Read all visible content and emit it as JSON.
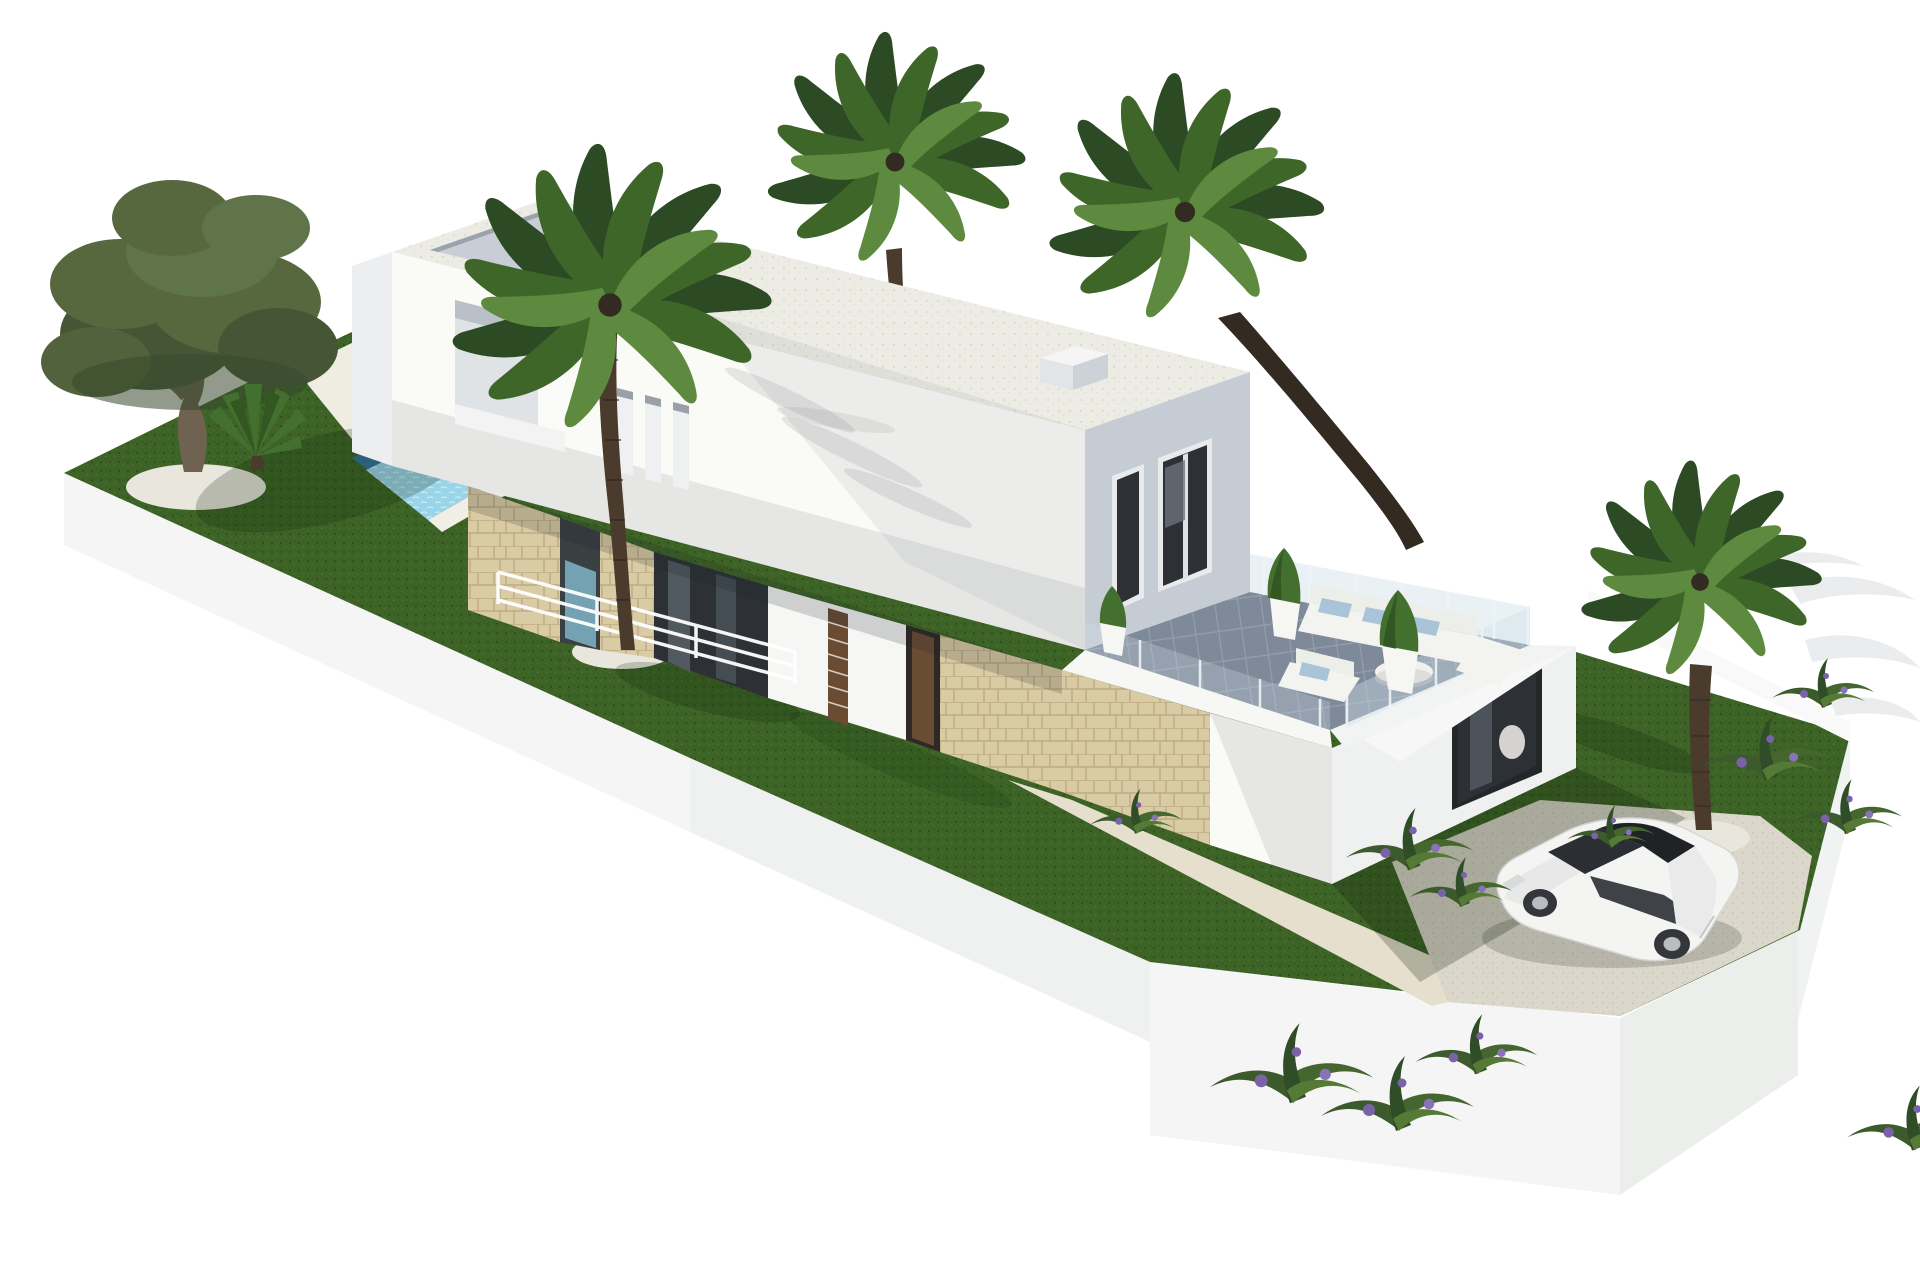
{
  "scene": {
    "description": "3D architectural render of a modern two-storey white villa with pool, palm trees, roof terrace, lawn and parked car on a white background",
    "background": "#ffffff"
  },
  "counts": {
    "palm_trees": 4,
    "olive_trees": 1,
    "cars": 1
  },
  "objects": {
    "villa": "Modern white villa",
    "upper_volume": "Upper floor volume with flat roof",
    "ground_floor": "Ground floor with stone-clad walls",
    "guest_wing": "Single-storey wing with roof terrace",
    "roof_terrace": "Roof terrace with outdoor lounge",
    "pool": "Swimming pool",
    "pool_deck": "White pool deck",
    "lawn": "Lawn",
    "driveway": "Gravel driveway",
    "walkway": "Garden path",
    "car": "White hatchback car",
    "olive_tree": "Olive tree",
    "palm_center": "Tall fan palm in front of the facade",
    "palm_back": "Tall fan palm behind the roof",
    "palm_leaning": "Tall leaning palm by the terrace",
    "palm_short": "Short palm beside the driveway",
    "sofa_set": "White outdoor sofa set with blue cushions",
    "planters": "White pots with clipped shrubs",
    "glass_railing": "Frameless glass railing",
    "retaining_wall": "White retaining walls of the plot",
    "flower_beds": "Tropical planting with purple flowers"
  },
  "colors": {
    "grass": "#3d6326",
    "grass_shadow": "#16300f",
    "plinth": "#f4f5f4",
    "plinth_shade": "#eceeec",
    "deck": "#efece2",
    "pool_dark": "#33719f",
    "pool_light": "#9ad4e8",
    "wall_front": "#fafaf7",
    "wall_side": "#c6ccd4",
    "wall_light": "#eceef0",
    "roof": "#ecebe4",
    "stone": "#d9cba4",
    "glass": "#2d3135",
    "wood": "#6a4c33",
    "terrace_floor": "#7e8a99",
    "railing_glass": "#cfe0e8",
    "sofa": "#f3f3f0",
    "cushion": "#a9c3d9",
    "planter": "#f6f6f3",
    "shrub": "#44702f",
    "palm_dark": "#2c4a23",
    "palm_mid": "#3e6629",
    "palm_light": "#5d8a3e",
    "trunk": "#4a3b2c",
    "trunk_dark": "#332a22",
    "olive_leaf": "#57683f",
    "olive_leaf_dark": "#465535",
    "olive_trunk": "#6f6250",
    "gravel": "#e9e6dd",
    "path": "#e6dfcd",
    "driveway": "#dbd7ca",
    "car_body": "#f4f4f3",
    "car_glass": "#2b2f33",
    "wheel": "#33363a",
    "rim": "#b9bdc0",
    "flower": "#7a62a8",
    "bush": "#3c5a2b",
    "wall_band": "#f8f9f8"
  }
}
